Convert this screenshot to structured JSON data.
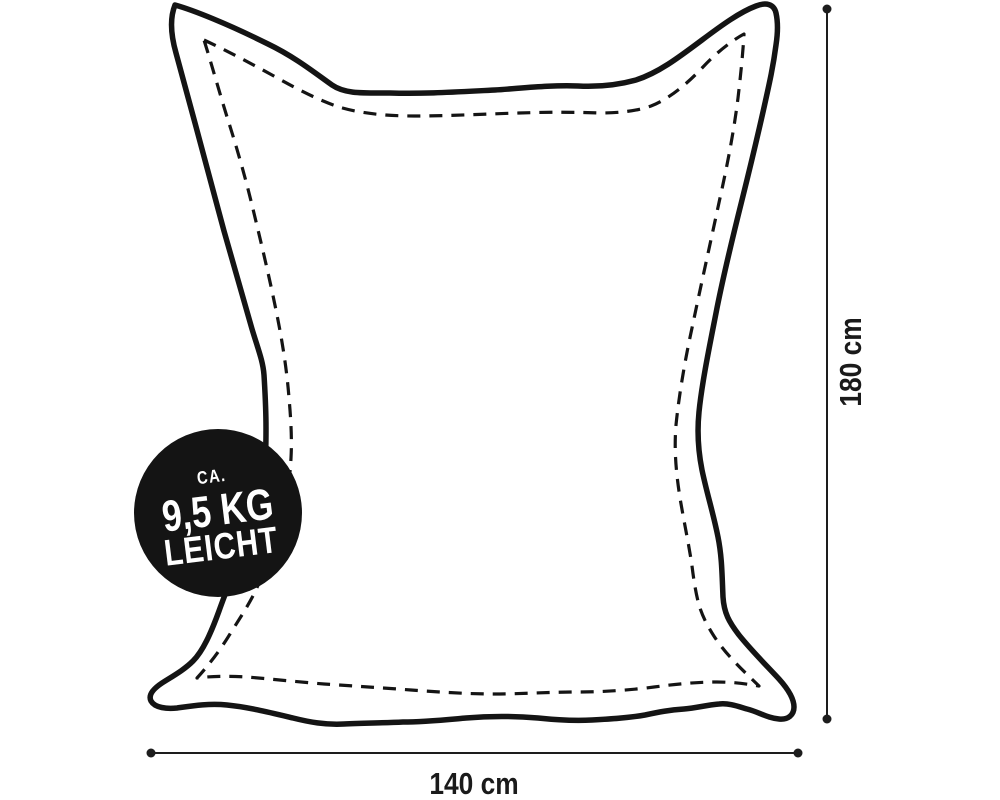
{
  "badge": {
    "line1": "CA.",
    "line2": "9,5 KG",
    "line3": "LEICHT",
    "background_color": "#141414",
    "text_color": "#ffffff"
  },
  "dimensions": {
    "height_label": "180 cm",
    "width_label": "140 cm"
  },
  "colors": {
    "background": "#ffffff",
    "ink": "#141414",
    "dimension_line": "#1d1d1d",
    "label_text": "#1a1a1a"
  }
}
